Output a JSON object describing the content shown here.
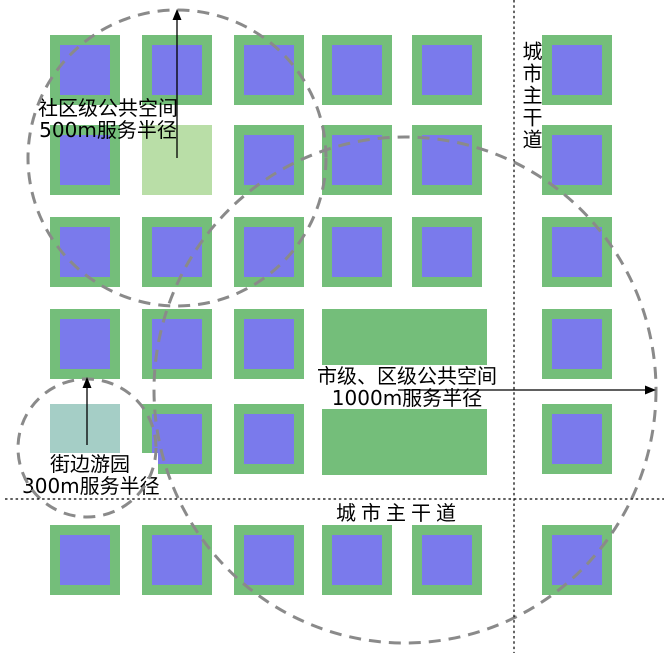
{
  "diagram": {
    "labels": {
      "community": [
        "社区级公共空间",
        "500m服务半径"
      ],
      "garden": [
        "街边游园",
        "300m服务半径"
      ],
      "plaza": [
        "市级、区级公共空间",
        "1000m服务半径"
      ],
      "road_vertical": "城市主干道",
      "road_horizontal": "城市主干道"
    },
    "colors": {
      "block_green": "#74BE7A",
      "block_blue": "#7A7AEC",
      "community_green": "#B9DEA7",
      "garden_teal": "#A5CEC6",
      "plaza_green": "#74BE7A",
      "circle_gray": "#8A8A8A",
      "road_line": "#000000",
      "arrow": "#000000",
      "background": "#FFFFFF"
    },
    "grid": {
      "cols": [
        50,
        142,
        234,
        322,
        412,
        542
      ],
      "rows": [
        35,
        125,
        217,
        309,
        404,
        525
      ],
      "cell_size": 70,
      "inner_size": 50,
      "inner_offset": 10,
      "skip_cells": [
        [
          1,
          1
        ],
        [
          4,
          0
        ],
        [
          3,
          3
        ],
        [
          3,
          4
        ],
        [
          4,
          3
        ],
        [
          4,
          4
        ]
      ]
    },
    "special_squares": {
      "community": {
        "x": 142,
        "y": 125,
        "width": 70,
        "height": 70
      },
      "garden": {
        "x": 50,
        "y": 404,
        "width": 70,
        "height": 70
      },
      "plaza": {
        "x": 322,
        "y": 309,
        "width": 165,
        "height": 166
      }
    },
    "circles": [
      {
        "name": "community-500m-radius-circle",
        "cx": 177,
        "cy": 158,
        "rx": 149,
        "ry": 148
      },
      {
        "name": "garden-300m-radius-circle",
        "cx": 87,
        "cy": 448,
        "rx": 69,
        "ry": 69
      },
      {
        "name": "plaza-1000m-radius-circle",
        "cx": 405,
        "cy": 390,
        "rx": 251,
        "ry": 253
      }
    ],
    "circle_style": {
      "stroke_width": 3,
      "dash": "12,8"
    },
    "arrows": [
      {
        "name": "community-radius-arrow",
        "x1": 177,
        "y1": 158,
        "x2": 177,
        "y2": 9,
        "dir": "up"
      },
      {
        "name": "garden-radius-arrow",
        "x1": 87,
        "y1": 445,
        "x2": 87,
        "y2": 377,
        "dir": "up"
      },
      {
        "name": "plaza-radius-arrow",
        "x1": 398,
        "y1": 390,
        "x2": 656,
        "y2": 390,
        "dir": "right"
      }
    ],
    "roads": [
      {
        "name": "vertical-main-road-line",
        "x1": 514,
        "y1": 0,
        "x2": 514,
        "y2": 653
      },
      {
        "name": "horizontal-main-road-line",
        "x1": 5,
        "y1": 499,
        "x2": 664,
        "y2": 499
      }
    ],
    "road_style": {
      "stroke_width": 1.2,
      "dash": "2.5,2.8"
    }
  }
}
